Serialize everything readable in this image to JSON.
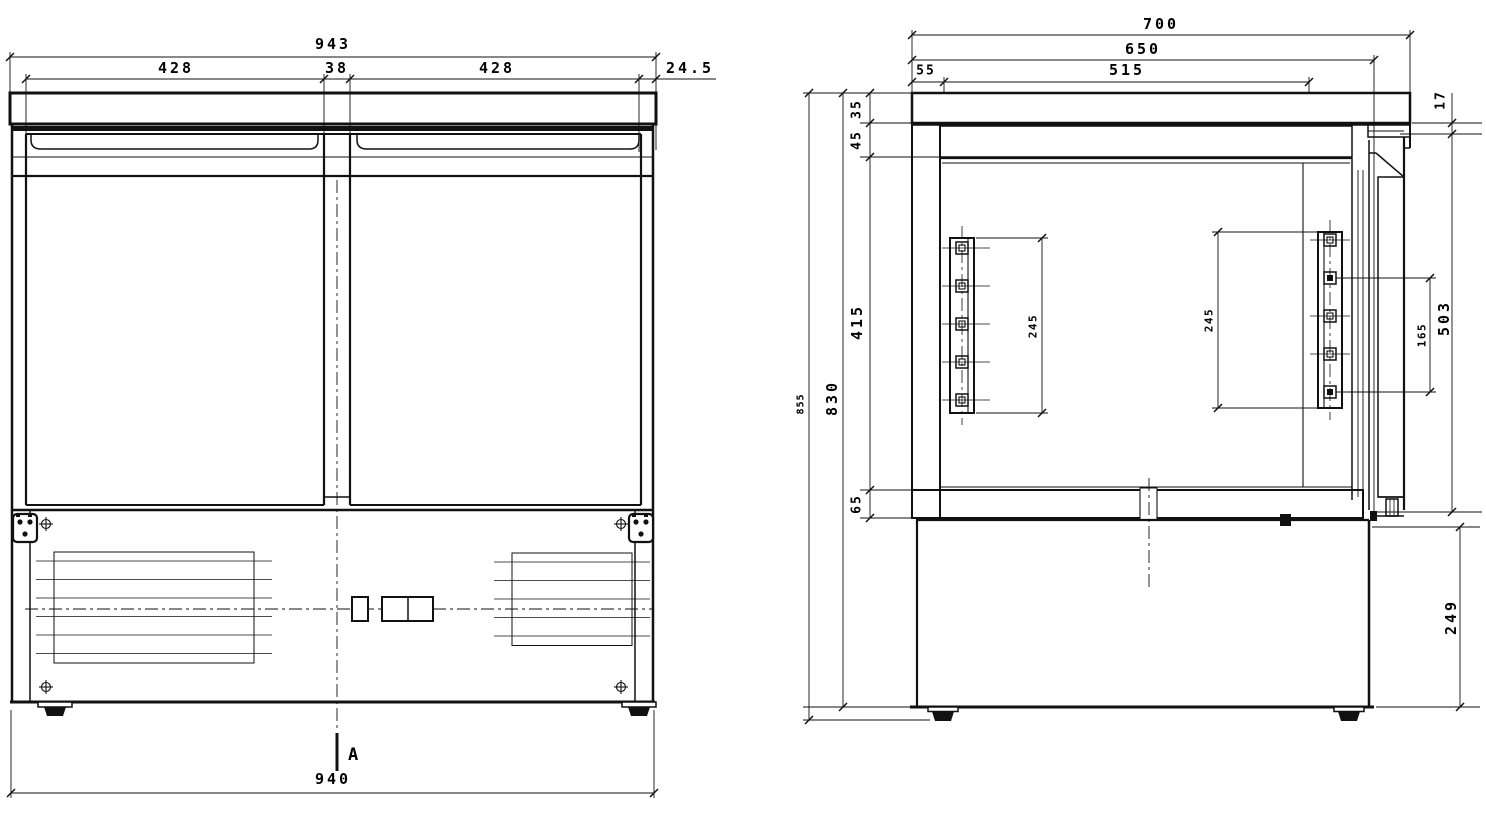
{
  "drawing": {
    "front_view": {
      "dims": {
        "overall_width": "943",
        "left_door_width": "428",
        "mullion_width": "38",
        "right_door_width": "428",
        "side_overhang": "24.5",
        "base_width": "940"
      },
      "section_mark": "A"
    },
    "section_view": {
      "dims": {
        "overall_depth": "700",
        "counter_depth": "650",
        "back_gap": "55",
        "interior_depth": "515",
        "top_lip": "17",
        "counter_thickness": "35",
        "top_insulation": "45",
        "interior_height": "415",
        "bottom_insulation": "65",
        "body_height": "830",
        "overall_height": "855",
        "base_height": "249",
        "left_rack_height": "245",
        "right_rack_height": "245",
        "rack_hole_span": "165",
        "door_height": "503"
      }
    }
  }
}
